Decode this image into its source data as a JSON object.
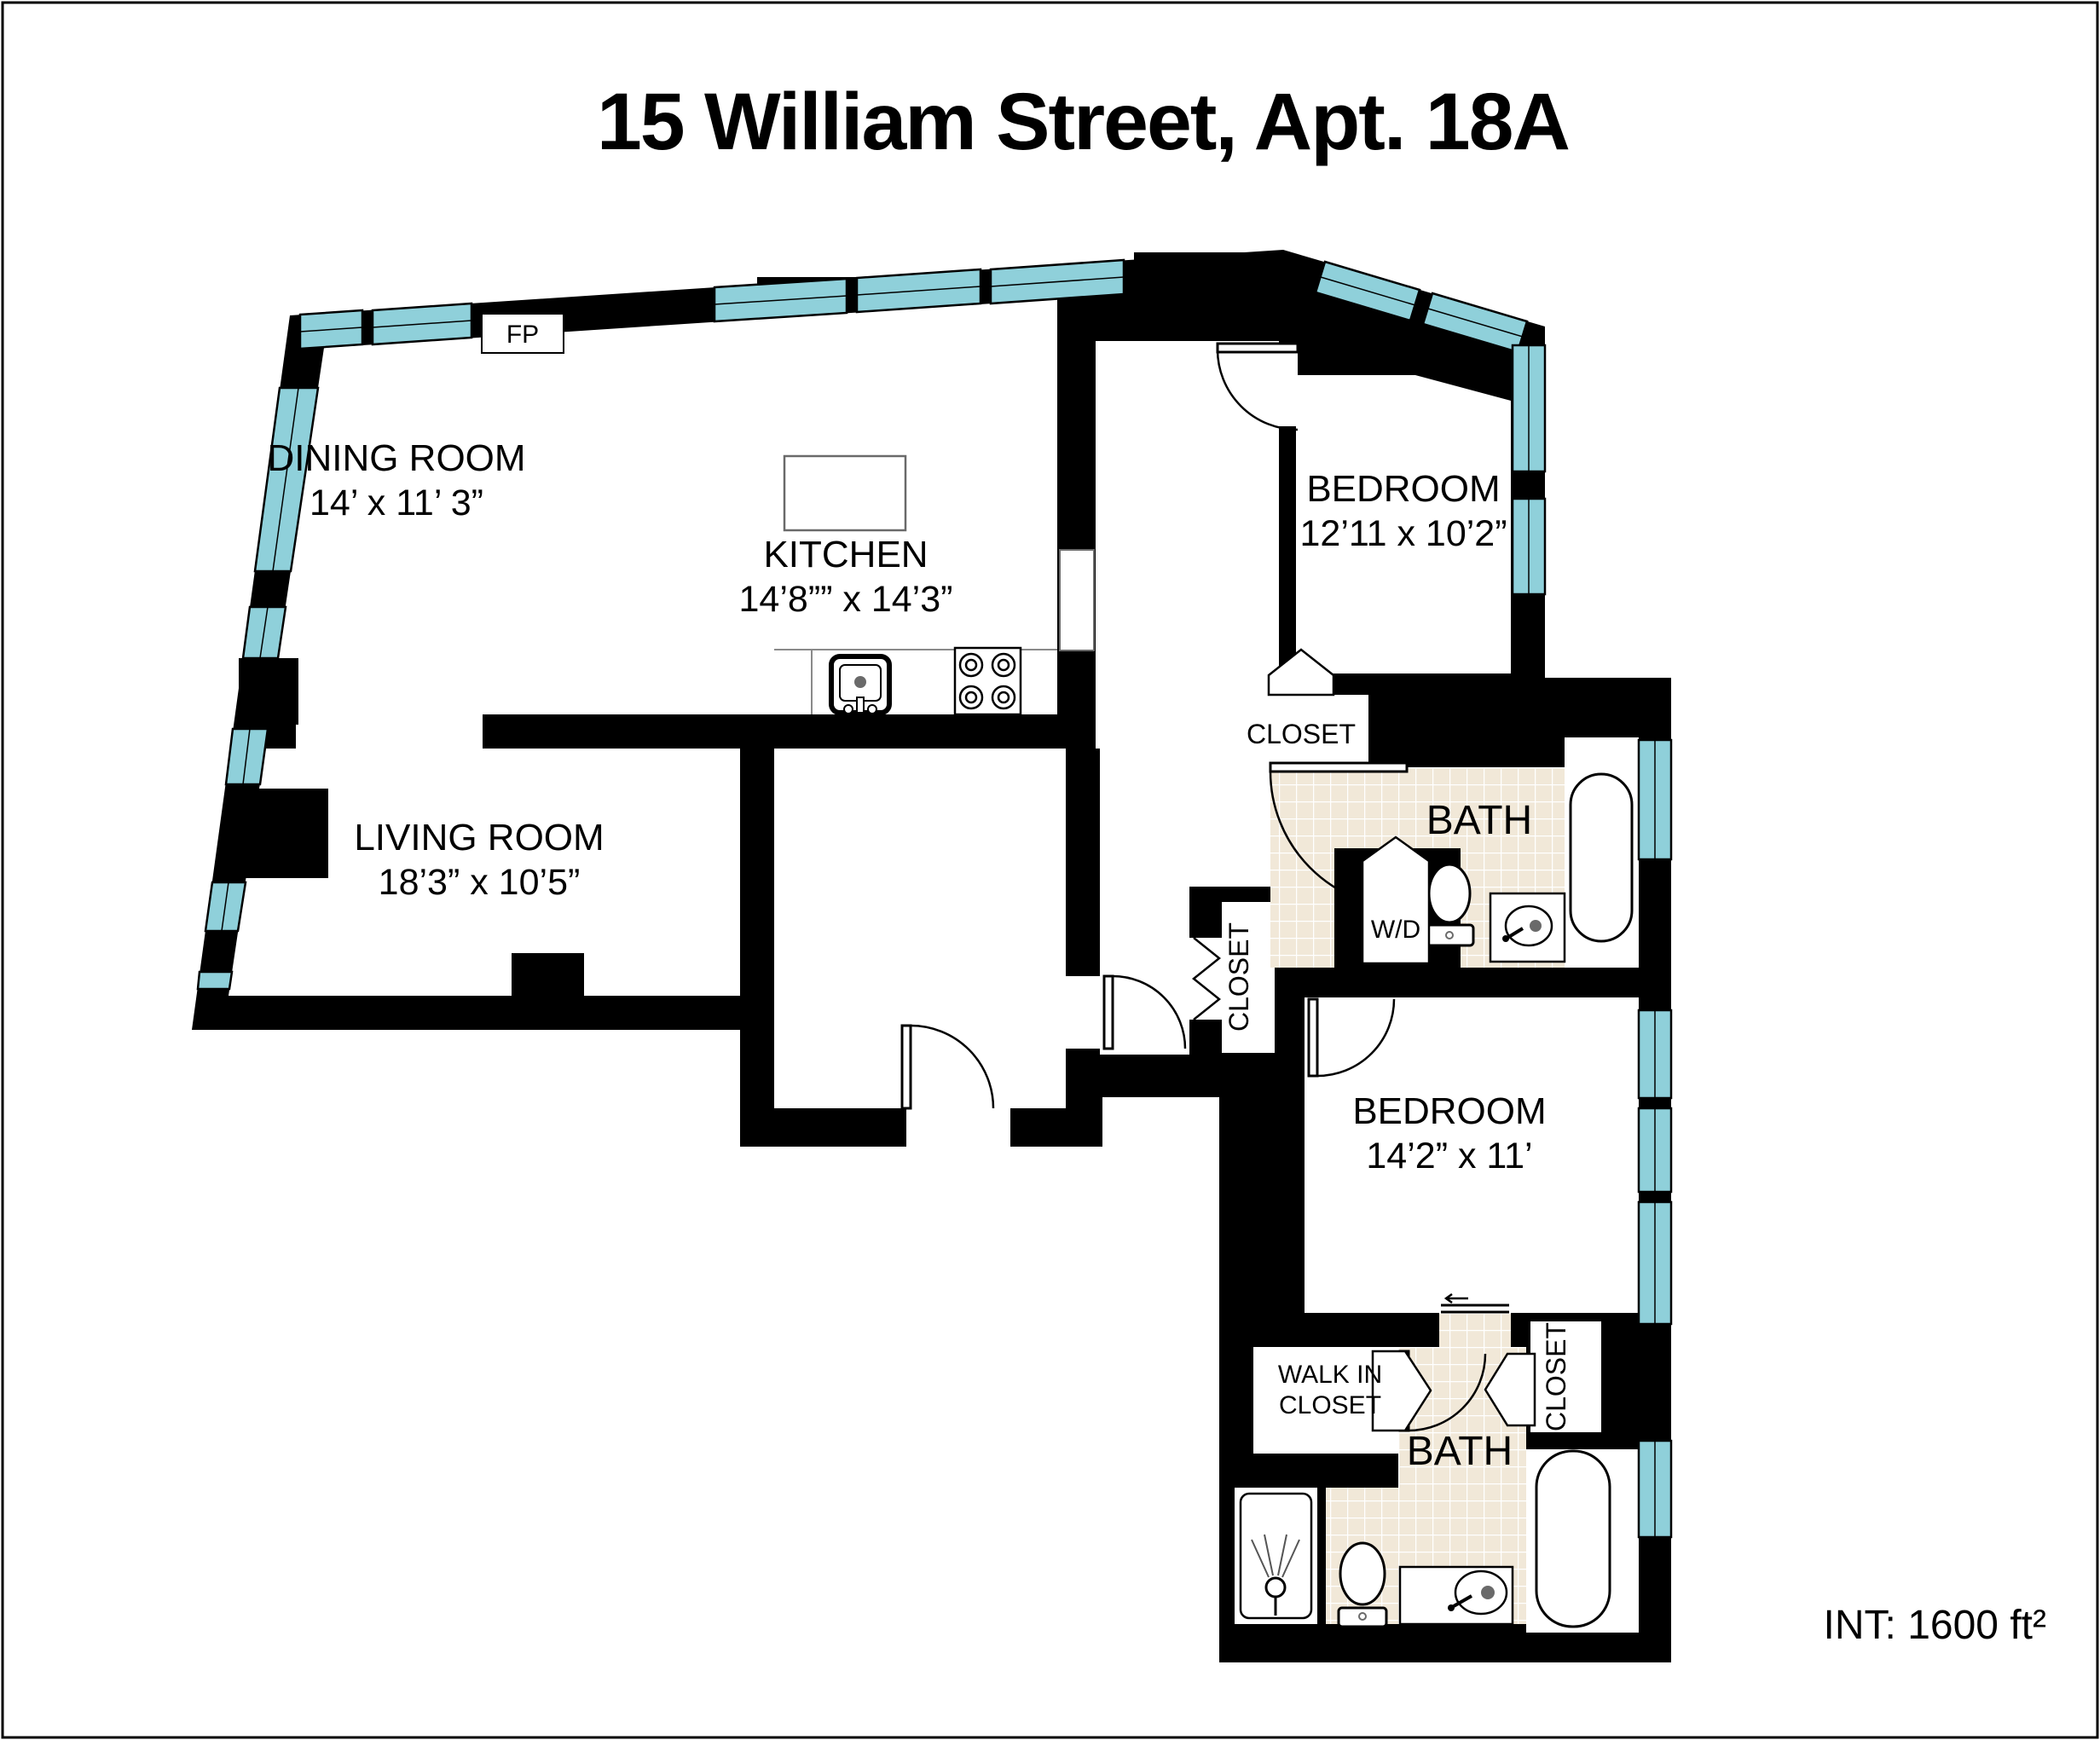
{
  "title": "15 William Street, Apt. 18A",
  "footer": {
    "interior_area": "INT: 1600 ft²"
  },
  "colors": {
    "wall": "#000000",
    "window_glass": "#8fd0da",
    "tile_floor": "#f1e8d8",
    "floor": "#ffffff"
  },
  "rooms": {
    "dining": {
      "name": "DINING ROOM",
      "dims": "14’  x 11’ 3”"
    },
    "kitchen": {
      "name": "KITCHEN",
      "dims": "14’8”” x 14’3”"
    },
    "living": {
      "name": "LIVING ROOM",
      "dims": "18’3” x 10’5”"
    },
    "bedroom1": {
      "name": "BEDROOM",
      "dims": "12’11 x 10’2”"
    },
    "bedroom2": {
      "name": "BEDROOM",
      "dims": "14’2” x 11’"
    },
    "bath1": {
      "name": "BATH"
    },
    "bath2": {
      "name": "BATH"
    },
    "closet1": {
      "name": "CLOSET"
    },
    "hall_closet": {
      "name": "CLOSET"
    },
    "bedroom2_closet": {
      "name": "CLOSET"
    },
    "walk_in_closet": {
      "line1": "WALK IN",
      "line2": "CLOSET"
    },
    "washer_dryer": {
      "name": "W/D"
    },
    "fireplace": {
      "name": "FP"
    }
  }
}
